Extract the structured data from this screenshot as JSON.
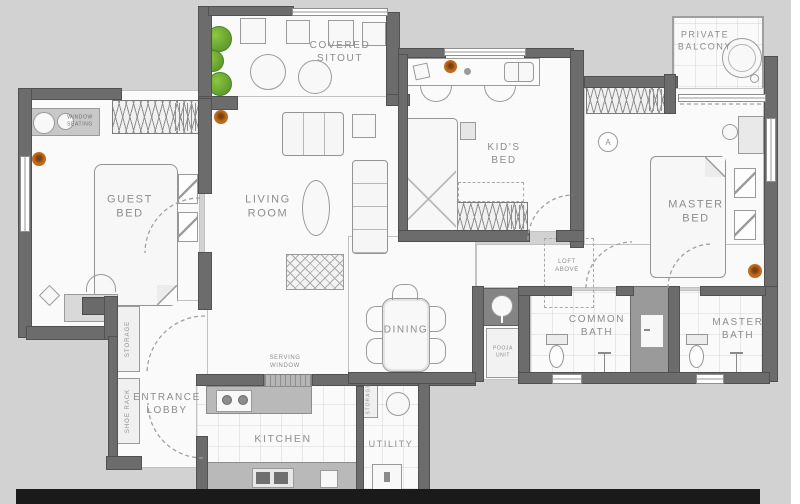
{
  "plan": {
    "title": "apartment-floor-plan",
    "rooms": {
      "covered_sitout": "COVERED\nSITOUT",
      "private_balcony": "PRIVATE\nBALCONY",
      "guest_bed": "GUEST\nBED",
      "living_room": "LIVING\nROOM",
      "kids_bed": "KID'S\nBED",
      "master_bed": "MASTER\nBED",
      "dining": "DINING",
      "common_bath": "COMMON\nBATH",
      "master_bath": "MASTER\nBATH",
      "entrance_lobby": "ENTRANCE\nLOBBY",
      "kitchen": "KITCHEN",
      "utility": "UTILITY"
    },
    "features": {
      "window_seating": "WINDOW\nSEATING",
      "storage_lobby": "STORAGE",
      "shoe_rack": "SHOE RACK",
      "storage_utility": "STORAGE",
      "serving_window": "SERVING\nWINDOW",
      "loft_above": "LOFT\nABOVE",
      "pooja_unit": "POOJA\nUNIT",
      "wall_marker": "A"
    },
    "colors": {
      "background": "#d2d2d2",
      "floor": "#fafafa",
      "wall": "#6c6c6c",
      "furniture_line": "#9a9a9a",
      "counter": "#b9b9b9",
      "label_text": "#8d8d8d",
      "plant_green": "#72b043",
      "flower_orange": "#b55f1d",
      "bottom_bar": "#1a1a1a"
    }
  }
}
